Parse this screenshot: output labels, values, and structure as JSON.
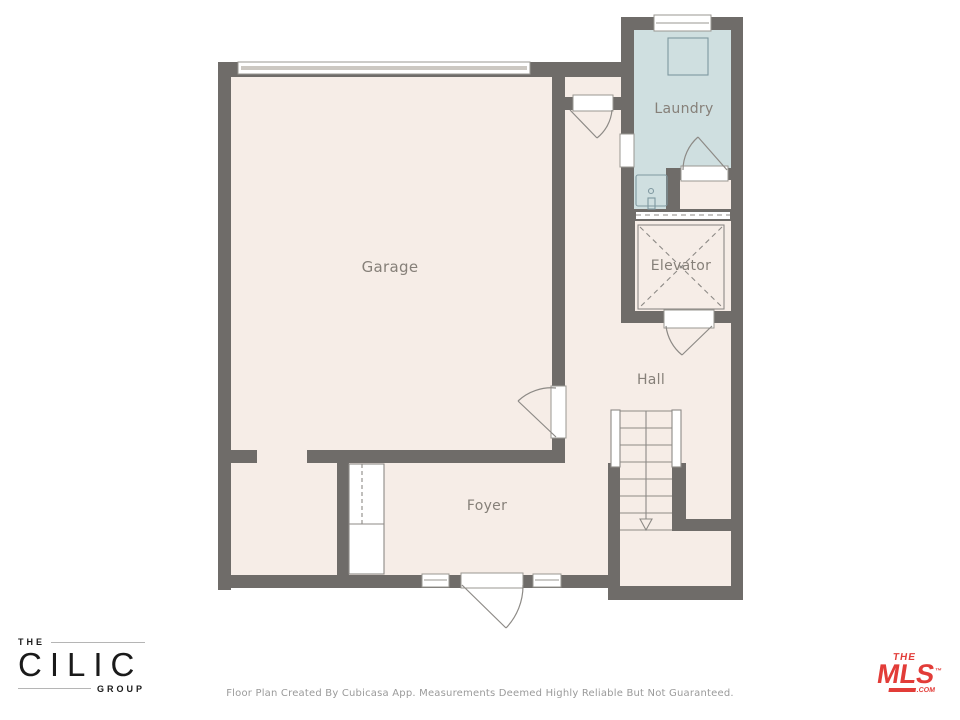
{
  "plan": {
    "rooms": [
      {
        "id": "garage",
        "label": "Garage"
      },
      {
        "id": "laundry",
        "label": "Laundry"
      },
      {
        "id": "elevator",
        "label": "Elevator"
      },
      {
        "id": "hall",
        "label": "Hall"
      },
      {
        "id": "foyer",
        "label": "Foyer"
      }
    ],
    "stairs": {
      "direction": "down",
      "arrow": "down-arrow"
    },
    "fixtures": [
      "garage-door",
      "washer",
      "sink",
      "closet",
      "entry-door",
      "windows"
    ]
  },
  "colors": {
    "wall": "#6f6c69",
    "room_fill": "#f6ede7",
    "laundry_fill": "#cfdfe0",
    "fixture_line": "#8d8a86",
    "label_text": "#868079",
    "mls_red": "#e23c38"
  },
  "branding": {
    "cilic": {
      "the": "THE",
      "name": "CILIC",
      "group": "GROUP"
    },
    "mls": {
      "the": "THE",
      "name": "MLS",
      "tm": "™",
      "com": ".COM"
    }
  },
  "footer": {
    "disclaimer": "Floor Plan Created By Cubicasa App. Measurements Deemed Highly Reliable But Not Guaranteed."
  }
}
